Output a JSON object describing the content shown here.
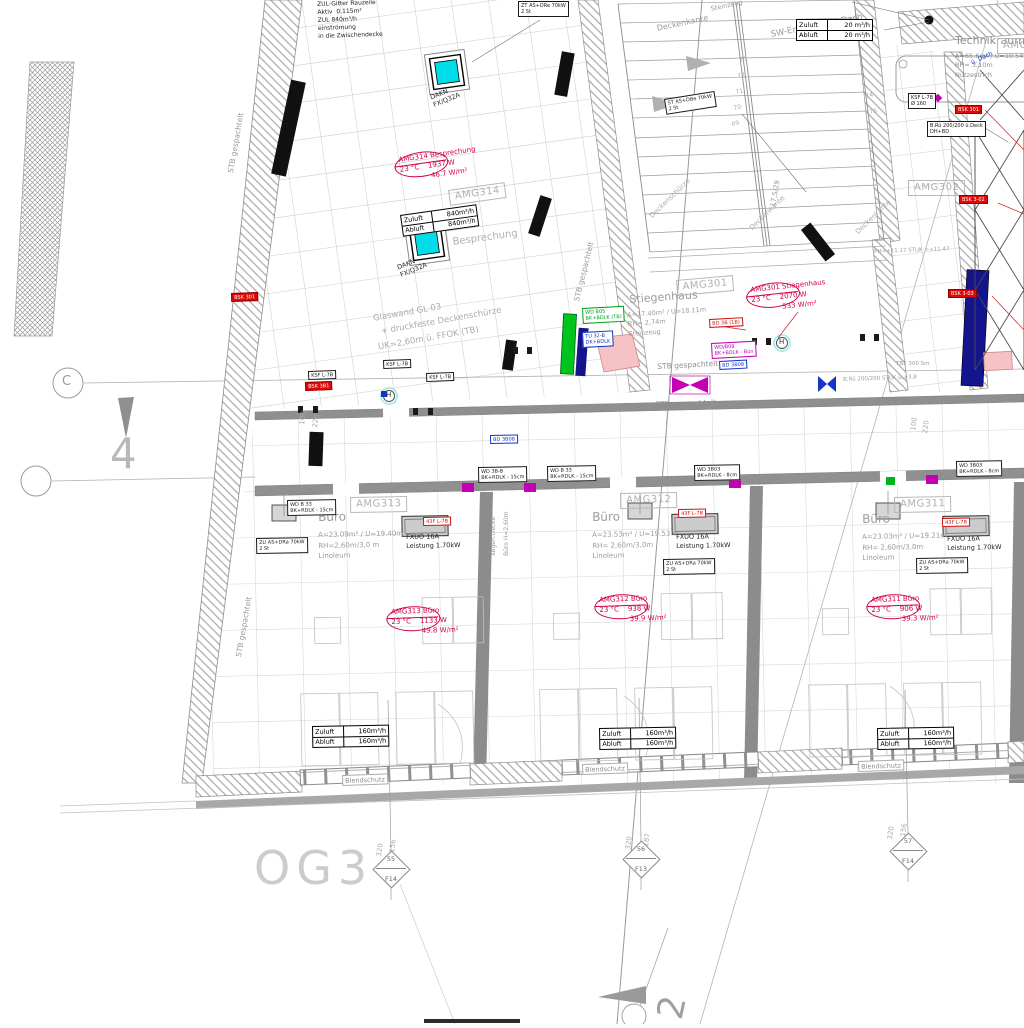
{
  "drawing": {
    "floor_code": "OG3"
  },
  "palette": {
    "red": "#d10045",
    "red_fill": "#dd0808",
    "magenta": "#c400b4",
    "blue": "#1433cc",
    "navy": "#14148c",
    "green": "#00b41e",
    "cyan": "#00dde8",
    "wall_gray": "#8f8f8f",
    "line_gray": "#9b9b9b"
  },
  "labels": [
    {
      "n": "note-zuluft-gitter",
      "t": "ZUL-Gitter Rauzeile\nAktiv  0.115m²\nZUL 840m³/h\neinströmung\nin die Zwischendecke",
      "x": 317,
      "y": 1,
      "s": 6,
      "c": "#1d1d1d",
      "r": -2,
      "lh": 1.35
    },
    {
      "n": "technikraum-title",
      "t": "Technikraum",
      "x": 955,
      "y": 34,
      "s": 11,
      "c": "#8d8d8d"
    },
    {
      "n": "technikraum-info",
      "t": "A=65.6m² / U=10.54m\nRH= 3,10m\nNutzestrich",
      "x": 955,
      "y": 52,
      "s": 6.5,
      "c": "#8d8d8d",
      "lh": 1.45
    },
    {
      "n": "note-blue-dach",
      "t": "ü. Dach",
      "x": 970,
      "y": 60,
      "s": 6,
      "c": "#2244cc",
      "r": -25
    },
    {
      "n": "stiegenhaus-title",
      "t": "Stiegenhaus",
      "x": 629,
      "y": 293,
      "s": 11,
      "c": "#9b9b9b",
      "r": -4
    },
    {
      "n": "stiegenhaus-info",
      "t": "A=17.40m² / U=18.11m\nRH= 2,74m\nSteinzeug",
      "x": 627,
      "y": 311,
      "s": 6.5,
      "c": "#9b9b9b",
      "r": -4,
      "lh": 1.45
    },
    {
      "n": "besprechung-title",
      "t": "Besprechung",
      "x": 452,
      "y": 237,
      "s": 10,
      "c": "#b0b0b0",
      "r": -8
    },
    {
      "n": "buero-1-title",
      "t": "Büro",
      "x": 318,
      "y": 510,
      "s": 12,
      "c": "#9b9b9b",
      "r": -1
    },
    {
      "n": "buero-1-info",
      "t": "A=23.09m² / U=19.40m\nRH=2,60m/3,0 m\nLinoleum",
      "x": 318,
      "y": 530,
      "s": 7,
      "c": "#9b9b9b",
      "r": -1,
      "lh": 1.5
    },
    {
      "n": "buero-2-title",
      "t": "Büro",
      "x": 592,
      "y": 510,
      "s": 12,
      "c": "#9b9b9b",
      "r": -1
    },
    {
      "n": "buero-2-info",
      "t": "A=23.53m² / U=19.53 m\nRH= 2,60m/3,0m\nLinoleum",
      "x": 592,
      "y": 530,
      "s": 7,
      "c": "#9b9b9b",
      "r": -1,
      "lh": 1.5
    },
    {
      "n": "buero-3-title",
      "t": "Büro",
      "x": 862,
      "y": 512,
      "s": 12,
      "c": "#9b9b9b",
      "r": -1
    },
    {
      "n": "buero-3-info",
      "t": "A=23.03m² / U=19.21m\nRH= 2,60m/3,0m\nLinoleum",
      "x": 862,
      "y": 532,
      "s": 7,
      "c": "#9b9b9b",
      "r": -1,
      "lh": 1.5
    },
    {
      "n": "stb-left-top",
      "t": "STB gespachtelt",
      "x": 226,
      "y": 172,
      "s": 7.5,
      "c": "#9b9b9b",
      "r": -80
    },
    {
      "n": "stb-left-bottom",
      "t": "STB gespachtelt",
      "x": 234,
      "y": 656,
      "s": 7.5,
      "c": "#9b9b9b",
      "r": -80
    },
    {
      "n": "stb-stair",
      "t": "STB gespachtelt",
      "x": 572,
      "y": 300,
      "s": 7.5,
      "c": "#9b9b9b",
      "r": -76
    },
    {
      "n": "stb-corridor-1",
      "t": "STB gespachtelt",
      "x": 657,
      "y": 362,
      "s": 7.5,
      "c": "#8f8f8f",
      "r": -3
    },
    {
      "n": "stb-corridor-2",
      "t": "STB gespachtelt",
      "x": 655,
      "y": 400,
      "s": 7.5,
      "c": "#8f8f8f",
      "r": -2
    },
    {
      "n": "glaswand-note",
      "t": "Glaswand GL 03\n  + druckfeste Deckenschürze\nUK=2,60m ü. FFOK (TB)",
      "x": 372,
      "y": 312,
      "s": 8.5,
      "c": "#ababab",
      "r": -10,
      "lh": 1.7
    },
    {
      "n": "deckenkante-top",
      "t": "Deckenkante",
      "x": 656,
      "y": 24,
      "s": 8,
      "c": "#9b9b9b",
      "r": -12
    },
    {
      "n": "sw-entlueftung",
      "t": "SW-Entlüftung ü Dach",
      "x": 770,
      "y": 30,
      "s": 8.5,
      "c": "#9b9b9b",
      "r": -11
    },
    {
      "n": "steinzeug-top",
      "t": "Steinzeug",
      "x": 710,
      "y": 5,
      "s": 6.5,
      "c": "#9b9b9b",
      "r": -12
    },
    {
      "n": "deckenschuerze-diag",
      "t": "Deckenschürze",
      "x": 648,
      "y": 214,
      "s": 7,
      "c": "#ababab",
      "r": -44
    },
    {
      "n": "deckenkante-diag-1",
      "t": "Deckenkante",
      "x": 748,
      "y": 226,
      "s": 7,
      "c": "#ababab",
      "r": -44
    },
    {
      "n": "deckenkante-diag-2",
      "t": "Deckenkante",
      "x": 854,
      "y": 230,
      "s": 7,
      "c": "#ababab",
      "r": -44
    },
    {
      "n": "abgeh-decke",
      "t": "abgeh.Decke",
      "x": 490,
      "y": 556,
      "s": 6,
      "c": "#9b9b9b",
      "r": -90
    },
    {
      "n": "buero-hoehe",
      "t": "Büro H=2,60m",
      "x": 503,
      "y": 556,
      "s": 6,
      "c": "#9b9b9b",
      "r": -90
    },
    {
      "n": "floor-code",
      "t": "OG3",
      "x": 254,
      "y": 840,
      "s": 46,
      "c": "#cccccc",
      "ls": 6
    },
    {
      "n": "stair-steigung",
      "t": "17,5/29",
      "x": 769,
      "y": 206,
      "s": 7,
      "c": "#9b9b9b",
      "r": -80
    },
    {
      "n": "tread-73",
      "t": "73",
      "x": 739,
      "y": 57,
      "s": 6,
      "c": "#adadad",
      "r": -12
    },
    {
      "n": "tread-72",
      "t": "72",
      "x": 737,
      "y": 73,
      "s": 6,
      "c": "#adadad",
      "r": -12
    },
    {
      "n": "tread-71",
      "t": "71",
      "x": 735,
      "y": 89,
      "s": 6,
      "c": "#adadad",
      "r": -12
    },
    {
      "n": "tread-70",
      "t": "70",
      "x": 733,
      "y": 105,
      "s": 6,
      "c": "#adadad",
      "r": -12
    },
    {
      "n": "tread-69",
      "t": "69",
      "x": 731,
      "y": 121,
      "s": 6,
      "c": "#adadad",
      "r": -12
    },
    {
      "n": "tread-74",
      "t": "74",
      "x": 865,
      "y": 93,
      "s": 6,
      "c": "#adadad",
      "r": -12
    },
    {
      "n": "tread-75",
      "t": "75",
      "x": 869,
      "y": 109,
      "s": 6,
      "c": "#adadad",
      "r": -12
    },
    {
      "n": "ph-note",
      "t": "PH=+11.17 STUK =+11.47",
      "x": 874,
      "y": 249,
      "s": 5.5,
      "c": "#9b9b9b",
      "r": -2
    },
    {
      "n": "bruestung-note",
      "t": "B.Rü 200/200 STUK ü.+3.8",
      "x": 843,
      "y": 377,
      "s": 5.5,
      "c": "#9b9b9b",
      "r": -2
    },
    {
      "n": "tb2-note",
      "t": "TB2 300 Sm",
      "x": 896,
      "y": 361,
      "s": 5.5,
      "c": "#9b9b9b"
    },
    {
      "n": "dim-100-left",
      "t": "100",
      "x": 298,
      "y": 424,
      "s": 7,
      "c": "#ababab",
      "r": -82
    },
    {
      "n": "dim-220-left",
      "t": "220",
      "x": 311,
      "y": 427,
      "s": 7,
      "c": "#ababab",
      "r": -82
    },
    {
      "n": "dim-100-right",
      "t": "100",
      "x": 909,
      "y": 430,
      "s": 7,
      "c": "#ababab",
      "r": -82
    },
    {
      "n": "dim-220-right",
      "t": "220",
      "x": 921,
      "y": 433,
      "s": 7,
      "c": "#ababab",
      "r": -82
    },
    {
      "n": "dim-win1-320",
      "t": "320",
      "x": 375,
      "y": 856,
      "s": 7,
      "c": "#ababab",
      "r": -82
    },
    {
      "n": "dim-win1-156",
      "t": "156",
      "x": 388,
      "y": 852,
      "s": 7,
      "c": "#ababab",
      "r": -82
    },
    {
      "n": "dim-win2-320",
      "t": "320",
      "x": 624,
      "y": 849,
      "s": 7,
      "c": "#ababab",
      "r": -82
    },
    {
      "n": "dim-win2-187",
      "t": "187",
      "x": 642,
      "y": 846,
      "s": 7,
      "c": "#ababab",
      "r": -82
    },
    {
      "n": "dim-win3-320",
      "t": "320",
      "x": 886,
      "y": 839,
      "s": 7,
      "c": "#ababab",
      "r": -82
    },
    {
      "n": "dim-win3-156",
      "t": "156",
      "x": 899,
      "y": 836,
      "s": 7,
      "c": "#ababab",
      "r": -82
    },
    {
      "n": "axis-label-c",
      "t": "C",
      "x": 62,
      "y": 374,
      "s": 13,
      "c": "#9b9b9b"
    },
    {
      "n": "axis-label-4",
      "t": "4",
      "x": 110,
      "y": 428,
      "s": 42,
      "c": "#b8b8b8"
    },
    {
      "n": "axis-label-2",
      "t": "2",
      "x": 648,
      "y": 1014,
      "s": 36,
      "c": "#a0a0a0",
      "r": -78
    },
    {
      "n": "hydrant-1-letter",
      "t": "H",
      "x": 386,
      "y": 391,
      "s": 7,
      "c": "#333333"
    },
    {
      "n": "hydrant-2-letter",
      "t": "H",
      "x": 779,
      "y": 338,
      "s": 7,
      "c": "#333333"
    },
    {
      "n": "skylight-1-label",
      "t": "DAKN\nFX/Q32A",
      "x": 429,
      "y": 94,
      "s": 6.5,
      "c": "#2a2a2a",
      "r": -22
    },
    {
      "n": "skylight-2-label",
      "t": "DAKN\nFX/Q32A",
      "x": 396,
      "y": 264,
      "s": 6.5,
      "c": "#2a2a2a",
      "r": -22
    },
    {
      "n": "radiator-1-label",
      "t": "FXUO 16A\nLeistung 1.70kW",
      "x": 406,
      "y": 533,
      "s": 6.5,
      "c": "#1d1d1d",
      "r": -1,
      "lh": 1.4
    },
    {
      "n": "radiator-2-label",
      "t": "FXUO 16A\nLeistung 1.70kW",
      "x": 676,
      "y": 533,
      "s": 6.5,
      "c": "#1d1d1d",
      "r": -1,
      "lh": 1.4
    },
    {
      "n": "radiator-3-label",
      "t": "FXUO 16A\nLeistung 1.70kW",
      "x": 947,
      "y": 535,
      "s": 6.5,
      "c": "#1d1d1d",
      "r": -1,
      "lh": 1.4
    }
  ],
  "room_codes": [
    {
      "t": "AMG314",
      "x": 448,
      "y": 190,
      "r": -8
    },
    {
      "t": "AMG301",
      "x": 676,
      "y": 280,
      "r": -5
    },
    {
      "t": "AMG302",
      "x": 908,
      "y": 180,
      "r": 0
    },
    {
      "t": "AMG313",
      "x": 350,
      "y": 497,
      "r": -1
    },
    {
      "t": "AMG312",
      "x": 620,
      "y": 493,
      "r": -1
    },
    {
      "t": "AMG311",
      "x": 894,
      "y": 497,
      "r": -1
    },
    {
      "t": "AMG30",
      "x": 997,
      "y": 38,
      "r": 0
    }
  ],
  "stamps": [
    {
      "n": "stamp-amg314",
      "x": 398,
      "y": 156,
      "r": -8,
      "l1": "AMG314 Besprechung",
      "l2": "23 °C    1937 W",
      "l3": "46.7 W/m²"
    },
    {
      "n": "stamp-amg301",
      "x": 750,
      "y": 286,
      "r": -6,
      "l1": "AMG301 Stiegenhaus",
      "l2": "23 °C    2070 W",
      "l3": "533 W/m²"
    },
    {
      "n": "stamp-amg313",
      "x": 391,
      "y": 608,
      "r": -2,
      "l1": "AMG313 Büro",
      "l2": "23 °C    1133 W",
      "l3": "49.8 W/m²"
    },
    {
      "n": "stamp-amg312",
      "x": 599,
      "y": 596,
      "r": -2,
      "l1": "AMG312 Büro",
      "l2": "23 °C    938 W",
      "l3": "39.9 W/m²"
    },
    {
      "n": "stamp-amg311",
      "x": 871,
      "y": 596,
      "r": -2,
      "l1": "AMG311 Büro",
      "l2": "23 °C    906 W",
      "l3": "39.3 W/m²"
    }
  ],
  "tables": [
    {
      "n": "airflow-technikraum",
      "x": 796,
      "y": 19,
      "r": 0,
      "rows": [
        [
          "Zuluft",
          "20 m³/h"
        ],
        [
          "Abluft",
          "20 m³/h"
        ]
      ]
    },
    {
      "n": "airflow-besprechung",
      "x": 400,
      "y": 215,
      "r": -8,
      "rows": [
        [
          "Zuluft",
          "840m³/h"
        ],
        [
          "Abluft",
          "840m³/h"
        ]
      ]
    },
    {
      "n": "airflow-buero-1",
      "x": 312,
      "y": 726,
      "r": -1,
      "rows": [
        [
          "Zuluft",
          "160m³/h"
        ],
        [
          "Abluft",
          "160m³/h"
        ]
      ]
    },
    {
      "n": "airflow-buero-2",
      "x": 599,
      "y": 728,
      "r": -1,
      "rows": [
        [
          "Zuluft",
          "160m³/h"
        ],
        [
          "Abluft",
          "160m³/h"
        ]
      ]
    },
    {
      "n": "airflow-buero-3",
      "x": 877,
      "y": 728,
      "r": -1,
      "rows": [
        [
          "Zuluft",
          "160m³/h"
        ],
        [
          "Abluft",
          "160m³/h"
        ]
      ]
    }
  ],
  "tags": [
    {
      "n": "tag-wd-corridor-1",
      "x": 478,
      "y": 467,
      "r": -1,
      "k": "black",
      "lines": [
        "WD 3B-B",
        "BK+RDLK - 15cm"
      ]
    },
    {
      "n": "tag-wd-corridor-2",
      "x": 547,
      "y": 466,
      "r": -1,
      "k": "black",
      "lines": [
        "WD B 33",
        "BK+RDLK - 15cm"
      ]
    },
    {
      "n": "tag-wd-corridor-3",
      "x": 694,
      "y": 465,
      "r": -1,
      "k": "black",
      "lines": [
        "WD 3B03",
        "BK+RDLK - 8cm"
      ]
    },
    {
      "n": "tag-wd-office-1",
      "x": 287,
      "y": 500,
      "r": -1,
      "k": "black",
      "lines": [
        "WD B 33",
        "BK+RDLK - 15cm"
      ]
    },
    {
      "n": "tag-wd-office-3",
      "x": 956,
      "y": 461,
      "r": -1,
      "k": "black",
      "lines": [
        "WD 3B03",
        "BK+RDLK - 8cm"
      ]
    },
    {
      "n": "tag-top-diffuser",
      "x": 518,
      "y": 1,
      "r": 0,
      "k": "black",
      "lines": [
        "ZT AS+DRe 70kW",
        "2 St"
      ]
    },
    {
      "n": "tag-hall-diffuser",
      "x": 664,
      "y": 99,
      "r": -9,
      "k": "black",
      "lines": [
        "ST AS+DBe 70kW",
        "2 St"
      ]
    },
    {
      "n": "tag-bruestung",
      "x": 927,
      "y": 121,
      "r": 0,
      "k": "black",
      "lines": [
        "B.Rü 200/200 ü.Deck",
        "DH+BD"
      ]
    },
    {
      "n": "tag-ksf-top",
      "x": 908,
      "y": 93,
      "r": 0,
      "k": "black",
      "lines": [
        "KSF L-7B",
        "Ø 160"
      ]
    },
    {
      "n": "tag-ksf-1",
      "x": 383,
      "y": 360,
      "r": -2,
      "k": "black",
      "lines": [
        "KSF L-7B"
      ]
    },
    {
      "n": "tag-ksf-2",
      "x": 426,
      "y": 373,
      "r": -2,
      "k": "black",
      "lines": [
        "KSF L-7B"
      ]
    },
    {
      "n": "tag-ksf-3",
      "x": 308,
      "y": 371,
      "r": -2,
      "k": "black",
      "lines": [
        "KSF L-7B"
      ]
    },
    {
      "n": "tag-zu-office-1",
      "x": 256,
      "y": 538,
      "r": -1,
      "k": "black",
      "lines": [
        "ZU AS+DRa 70kW",
        "2 St"
      ]
    },
    {
      "n": "tag-zu-office-2",
      "x": 663,
      "y": 559,
      "r": -1,
      "k": "black",
      "lines": [
        "ZU AS+DRa 70kW",
        "2 St"
      ]
    },
    {
      "n": "tag-zu-office-3",
      "x": 916,
      "y": 558,
      "r": -1,
      "k": "black",
      "lines": [
        "ZU AS+DRa 70kW",
        "2 St"
      ]
    },
    {
      "n": "tag-valve-1",
      "x": 423,
      "y": 517,
      "r": -1,
      "k": "red",
      "lines": [
        "43F L-7B"
      ]
    },
    {
      "n": "tag-valve-2",
      "x": 678,
      "y": 509,
      "r": -1,
      "k": "red",
      "lines": [
        "43F L-7B"
      ]
    },
    {
      "n": "tag-valve-3",
      "x": 942,
      "y": 518,
      "r": -1,
      "k": "red",
      "lines": [
        "43F L-7B"
      ]
    },
    {
      "n": "tag-bd-3b-1b",
      "x": 709,
      "y": 319,
      "r": -3,
      "k": "red",
      "lines": [
        "BD 3B (1B)"
      ]
    },
    {
      "n": "tag-bsk-left-1",
      "x": 231,
      "y": 293,
      "r": -2,
      "k": "redfill",
      "lines": [
        "BSK 301"
      ]
    },
    {
      "n": "tag-bsk-left-2",
      "x": 305,
      "y": 382,
      "r": -2,
      "k": "redfill",
      "lines": [
        "BSK 3B1"
      ]
    },
    {
      "n": "tag-bsk-right-1",
      "x": 955,
      "y": 105,
      "r": 0,
      "k": "redfill",
      "lines": [
        "BSK 301"
      ]
    },
    {
      "n": "tag-bsk-right-2",
      "x": 959,
      "y": 195,
      "r": 0,
      "k": "redfill",
      "lines": [
        "BSK 3-02"
      ]
    },
    {
      "n": "tag-bsk-right-3",
      "x": 948,
      "y": 289,
      "r": 0,
      "k": "redfill",
      "lines": [
        "BSK 3-03"
      ]
    },
    {
      "n": "tag-wd-b08",
      "x": 711,
      "y": 343,
      "r": -3,
      "k": "magenta",
      "lines": [
        "WD/B08",
        "BK+BDLK - Bün"
      ]
    },
    {
      "n": "tag-bd-3b08-1",
      "x": 719,
      "y": 361,
      "r": -3,
      "k": "blue",
      "lines": [
        "BD 3B08"
      ]
    },
    {
      "n": "tag-bd-3b08-2",
      "x": 490,
      "y": 435,
      "r": -1,
      "k": "blue",
      "lines": [
        "BD 3B08"
      ]
    },
    {
      "n": "tag-tu-32b",
      "x": 582,
      "y": 332,
      "r": -3,
      "k": "blue",
      "lines": [
        "TU 32-B",
        "DK+BDLK"
      ]
    },
    {
      "n": "tag-wd-b05",
      "x": 582,
      "y": 308,
      "r": -3,
      "k": "green",
      "lines": [
        "WD B05",
        "BK+BDLK (TB)"
      ]
    },
    {
      "n": "tag-blendschutz-1",
      "x": 342,
      "y": 775,
      "r": -2,
      "k": "gray",
      "lines": [
        "Blendschutz"
      ]
    },
    {
      "n": "tag-blendschutz-2",
      "x": 582,
      "y": 764,
      "r": -2,
      "k": "gray",
      "lines": [
        "Blendschutz"
      ]
    },
    {
      "n": "tag-blendschutz-3",
      "x": 858,
      "y": 761,
      "r": -2,
      "k": "gray",
      "lines": [
        "Blendschutz"
      ]
    }
  ],
  "diamonds": [
    {
      "n": "window-marker-55-f14",
      "cx": 391,
      "cy": 869,
      "top": "55",
      "bottom": "F14"
    },
    {
      "n": "window-marker-56-f13",
      "cx": 641,
      "cy": 859,
      "top": "56",
      "bottom": "F13"
    },
    {
      "n": "window-marker-57-f14",
      "cx": 908,
      "cy": 851,
      "top": "57",
      "bottom": "F14"
    }
  ]
}
